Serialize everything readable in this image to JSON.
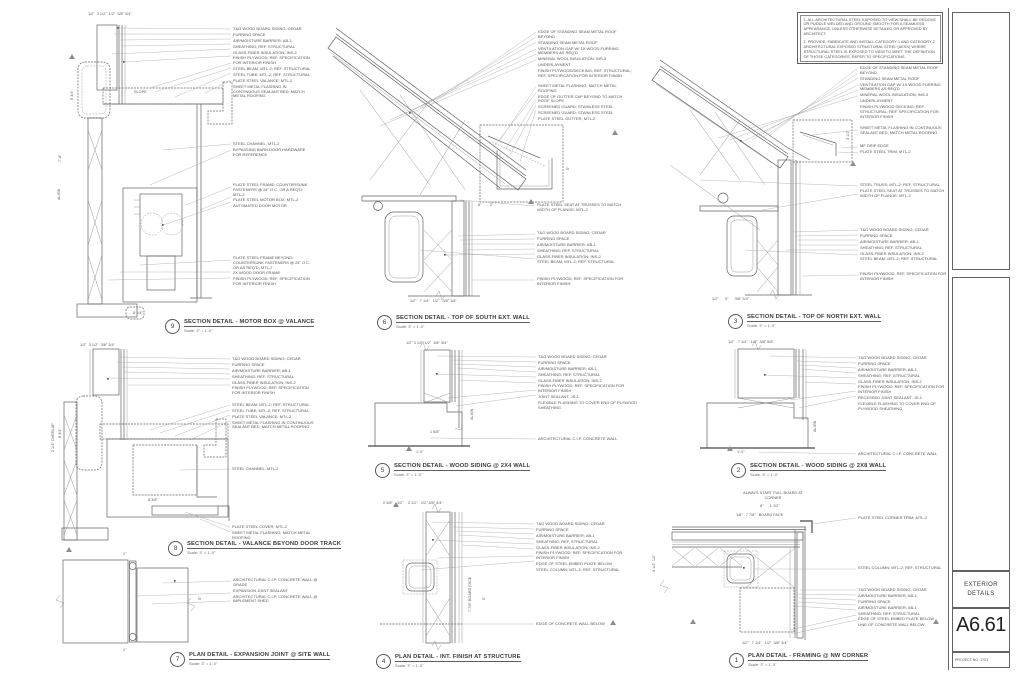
{
  "sheet": {
    "notes": [
      "1. ALL ARCHITECTURAL STEEL EXPOSED TO VIEW SHALL BE GROOVE OR PUDDLE WELDED AND GROUND SMOOTH FOR A SEAMLESS APPEARANCE, UNLESS OTHERWISE DETAILED OR APPROVED BY ARCHITECT.",
      "2. PROVIDE, FABRICATE AND INSTALL CATEGORY 1 AND CATEGORY 2 ARCHITECTURAL EXPOSED STRUCTURAL STEEL (AESS) WHERE STRUCTURAL STEEL IS EXPOSED TO VIEW TO MEET THE DEFINITION OF THOSE CATEGORIES. REFER TO SPECIFICATIONS."
    ],
    "title_block": {
      "sheet_name": "EXTERIOR DETAILS",
      "sheet_number": "A6.61",
      "project_no": "PROJECT NO. 1703"
    }
  },
  "details": [
    {
      "num": "9",
      "title": "SECTION DETAIL - MOTOR BOX @ VALANCE",
      "scale": "Scale:  3\" = 1'-0\"",
      "groups": [
        [
          "T&G WOOD BOARD SIDING; CEDAR",
          "FURRING SPACE",
          "AIR/MOISTURE BARRIER; AB-1",
          "SHEATHING; REF. STRUCTURAL",
          "GLASS-FIBER INSULATION; INS-2",
          "FINISH PLYWOOD; REF. SPECIFICATION FOR INTERIOR FINISH",
          "STEEL BEAM; MTL-2; REF. STRUCTURAL",
          "STEEL TUBE; MTL-2; REF. STRUCTURAL",
          "PLATE STEEL VALANCE; MTL-2",
          "SHEET METAL FLASHING IN CONTINUOUS SEALANT BED; MATCH METAL ROOFING"
        ],
        [
          "STEEL CHANNEL; MTL-2",
          "BYPASSING BARN DOOR HARDWARE FOR REFERENCE"
        ],
        [
          "PLATE STEEL FRAME; COUNTERSUNK FASTENERS @ 24\" O.C. OR A REQ'D; MTL-2",
          "PLATE STEEL MOTOR BOX; MTL-2",
          "AUTOMATED DOOR MOTOR"
        ],
        [
          "PLATE STEEL FRAME BEYOND; COUNTERSUNK FASTENERS @ 24\" O.C. OR AS REQ'D; MTL-2",
          "2X WOOD DOOR FRAME",
          "FINISH PLYWOOD; REF. SPECIFICATION FOR INTERIOR FINISH"
        ]
      ],
      "dims": [
        "1/2\"  3 1/2\"  1/2\"  3/8\" 3/4\"",
        "7'-8\"",
        "5 3/4\"",
        "8 1/4\"",
        "SLOPE",
        "ALIGN"
      ]
    },
    {
      "num": "6",
      "title": "SECTION DETAIL - TOP OF SOUTH EXT. WALL",
      "scale": "Scale:  3\" = 1'-0\"",
      "groups": [
        [
          "EDGE OF STANDING SEAM METAL ROOF BEYOND",
          "STANDING SEAM METAL ROOF",
          "VENTILATION GAP W/ 1X WOOD FURRING MEMBERS AS REQ'D",
          "MINERAL WOOL INSULATION; INS-3",
          "UNDERLAYMENT",
          "FINISH PLYWOOD/DECKING; REF. STRUCTURAL; REF. SPECIFICATION FOR INTERIOR FINISH"
        ],
        [
          "SHEET METAL FLASHING; MATCH METAL ROOFING",
          "EDGE OF GUTTER CAP BEYOND TO MATCH ROOF SLOPE",
          "SCREENED GUARD; STAINLESS STEEL",
          "SCREENED GUARD; STAINLESS STEEL",
          "PLATE STEEL GUTTER; MTL-2"
        ],
        [
          "PLATE STEEL SEAT AT TRUSSES TO MATCH WIDTH OF FLANGE; MTL-2"
        ],
        [
          "T&G WOOD BOARD SIDING; CEDAR",
          "FURRING SPACE",
          "AIR/MOISTURE BARRIER; AB-1",
          "SHEATHING; REF. STRUCTURAL",
          "GLASS-FIBER INSULATION; INS-2",
          "STEEL BEAM; MTL-2; REF. STRUCTURAL"
        ],
        [
          "FINISH PLYWOOD; REF. SPECIFICATION FOR INTERIOR FINISH"
        ]
      ],
      "dims": [
        "8\"        2\"",
        "1/2\"   7 1/4\"   1/2\"   3/8\" 3/4\"",
        "5\""
      ]
    },
    {
      "num": "3",
      "title": "SECTION DETAIL - TOP OF NORTH EXT. WALL",
      "scale": "Scale:  3\" = 1'-0\"",
      "groups": [
        [
          "EDGE OF STANDING SEAM METAL ROOF BEYOND",
          "STANDING SEAM METAL ROOF",
          "VENTILATION GAP W/ 1X WOOD FURRING MEMBERS AS REQ'D",
          "MINERAL WOOL INSULATION; INS-3",
          "UNDERLAYMENT",
          "FINISH PLYWOOD DECKING; REF. STRUCTURAL; REF. SPECIFICATION FOR INTERIOR FINISH"
        ],
        [
          "SHEET METAL FLASHING IN CONTINUOUS SEALANT BED; MATCH METAL ROOFING"
        ],
        [
          "MF DRIP EDGE",
          "PLATE STEEL TRIM; MTL-2"
        ],
        [
          "STEEL TRUSS; MTL-2; REF. STRUCTURAL",
          "PLATE STEEL SEAT AT TRUSSES TO MATCH WIDTH OF FLANGE; MTL-2"
        ],
        [
          "T&G WOOD BOARD SIDING; CEDAR",
          "FURRING SPACE",
          "AIR/MOISTURE BARRIER; AB-1",
          "SHEATHING; REF. STRUCTURAL",
          "GLASS-FIBER INSULATION; INS-2",
          "STEEL BEAM; MTL-2; REF. STRUCTURAL"
        ],
        [
          "FINISH PLYWOOD; REF. SPECIFICATION FOR INTERIOR FINISH"
        ]
      ],
      "dims": [
        "1/2\"      5\"      3/8\" 3/4\"",
        "3 1/2\""
      ]
    },
    {
      "num": "8",
      "title": "SECTION DETAIL - VALANCE BEYOND DOOR TRACK",
      "scale": "Scale:  3\" = 1'-0\"",
      "groups": [
        [
          "T&G WOOD BOARD SIDING; CEDAR",
          "FURRING SPACE",
          "AIR/MOISTURE BARRIER; AB-1",
          "SHEATHING; REF. STRUCTURAL",
          "GLASS-FIBER INSULATION; INS-2",
          "FINISH PLYWOOD; REF. SPECIFICATION FOR INTERIOR FINISH"
        ],
        [
          "STEEL BEAM; MTL-2; REF. STRUCTURAL",
          "STEEL TUBE; MTL-2; REF. STRUCTURAL",
          "PLATE STEEL VALANCE; MTL-2",
          "SHEET METAL FLASHING IN CONTINUOUS SEALANT BED; MATCH METAL ROOFING"
        ],
        [
          "STEEL CHANNEL; MTL-2"
        ],
        [
          "PLATE STEEL COVER; MTL-2",
          "SHEET METAL FLASHING; MATCH METAL ROOFING"
        ]
      ],
      "dims": [
        "1/2\"  3 1/2\"  3/8\" 3/4\"",
        "2 1/4\" OVERLAP",
        "8 3/4\"",
        "6 3/8\""
      ]
    },
    {
      "num": "5",
      "title": "SECTION DETAIL - WOOD SIDING @ 2X4 WALL",
      "scale": "Scale:  3\" = 1'-0\"",
      "groups": [
        [
          "T&G WOOD BOARD SIDING; CEDAR",
          "FURRING SPACE",
          "AIR/MOISTURE BARRIER; AB-1",
          "SHEATHING; REF. STRUCTURAL",
          "GLASS-FIBER INSULATION; INS-2",
          "FINISH PLYWOOD; REF. SPECIFICATION FOR INTERIOR FINISH",
          "JOINT SEALANT; JS-1",
          "FLEXIBLE FLASHING TO COVER END OF PLYWOOD SHEATHING"
        ],
        [
          "ARCHITECTURAL C.I.P. CONCRETE WALL"
        ]
      ],
      "dims": [
        "1/2\" 3 1/2\" 1/2\"  3/8\" 3/4\"",
        "1'-0\"",
        "1 5/8\"",
        "ALIGN"
      ]
    },
    {
      "num": "2",
      "title": "SECTION DETAIL - WOOD SIDING @ 2X8 WALL",
      "scale": "Scale:  3\" = 1'-0\"",
      "groups": [
        [
          "T&G WOOD BOARD SIDING; CEDAR",
          "FURRING SPACE",
          "AIR/MOISTURE BARRIER; AB-1",
          "SHEATHING; REF. STRUCTURAL",
          "GLASS-FIBER INSULATION; INS-2",
          "FINISH PLYWOOD; REF. SPECIFICATION FOR INTERIOR FINISH",
          "RECESSED JOINT SEALANT; JS-1",
          "FLEXIBLE FLASHING TO COVER END OF PLYWOOD SHEATHING"
        ],
        [
          "ARCHITECTURAL C.I.P. CONCRETE WALL"
        ]
      ],
      "dims": [
        "1/2\"   7 1/4\"   1/2\"  3/8\" 5/8\"",
        "1'-0\"",
        "ALIGN"
      ]
    },
    {
      "num": "7",
      "title": "PLAN DETAIL - EXPANSION JOINT @ SITE WALL",
      "scale": "Scale:  3\" = 1'-0\"",
      "groups": [
        [
          "ARCHITECTURAL C.I.P. CONCRETE WALL @ GRADE",
          "EXPANSION JOINT SEALANT",
          "ARCHITECTURAL C.I.P. CONCRETE WALL @ IMPLEMENT SHED"
        ]
      ],
      "dims": [
        "1\"",
        "1\"",
        "5\""
      ]
    },
    {
      "num": "4",
      "title": "PLAN DETAIL - INT. FINISH AT STRUCTURE",
      "scale": "Scale:  3\" = 1'-0\"",
      "groups": [
        [
          "T&G WOOD BOARD SIDING; CEDAR",
          "FURRING SPACE",
          "AIR/MOISTURE BARRIER; AB-1",
          "SHEATHING; REF. STRUCTURAL",
          "GLASS-FIBER INSULATION; INS-2",
          "FINISH PLYWOOD; REF. SPECIFICATION FOR INTERIOR FINISH",
          "EDGE OF STEEL EMBED PLATE BELOW",
          "STEEL COLUMN; MTL-2; REF. STRUCTURAL"
        ],
        [
          "EDGE OF CONCRETE WALL BELOW"
        ]
      ],
      "dims": [
        "2 3/8\"    1/2\"    2 1/2\"   1/2\" 3/8\" 3/4\"",
        "7 7/8\" BOARD FACE",
        "5\""
      ]
    },
    {
      "num": "1",
      "title": "PLAN DETAIL - FRAMING @ NW CORNER",
      "scale": "Scale:  3\" = 1'-0\"",
      "note": "ALWAYS START FULL BOARD AT CORNER",
      "groups": [
        [
          "PLATE STEEL CORNER TRIM; MTL-2"
        ],
        [
          "STEEL COLUMN; MTL-2; REF. STRUCTURAL"
        ],
        [
          "T&G WOOD BOARD SIDING; CEDAR",
          "AIR/MOISTURE BARRIER; AB-1",
          "FURRING SPACE",
          "AIR/MOISTURE BARRIER; AB-1",
          "SHEATHING; REF. STRUCTURAL",
          "EDGE OF STEEL EMBED PLATE BELOW",
          "LINE OF CONCRETE WALL BELOW"
        ]
      ],
      "dims": [
        "8\"      1 1/2\"",
        "1/8\"   7 7/8\"   BOARD FACE",
        "1/2\"   7 1/4\"   1/2\"  3/8\" 3/4\"",
        "3 1/2\" 1/2\""
      ]
    }
  ]
}
